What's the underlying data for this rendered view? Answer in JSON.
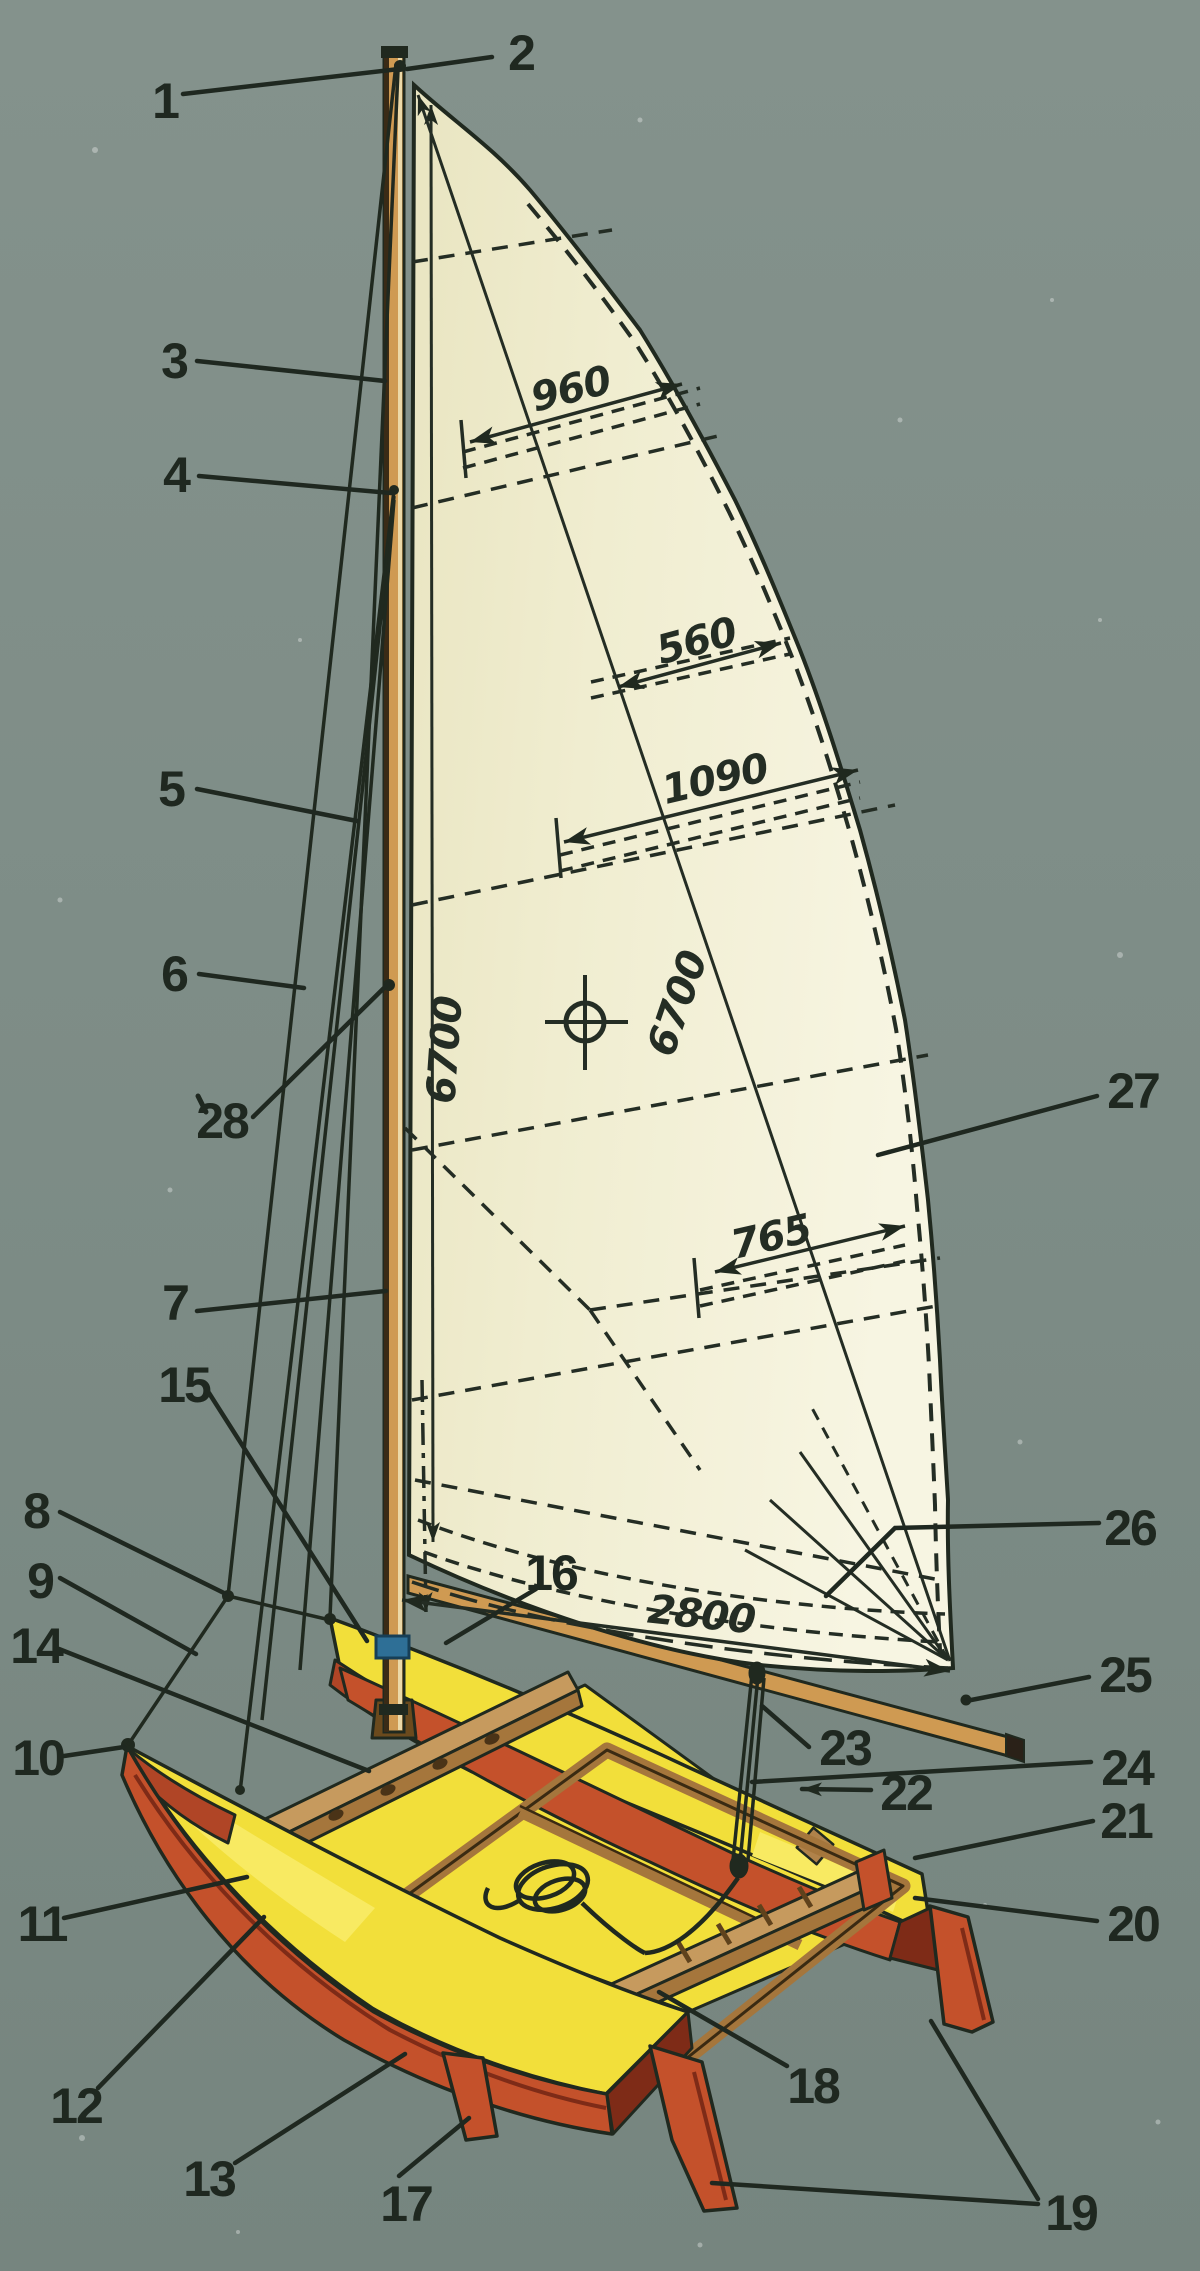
{
  "figure": {
    "kind": "technical-parts-diagram",
    "subject": "sailing catamaran with fully battened mainsail",
    "style": "vintage magazine color plate",
    "background_color": "#7d8c86",
    "colors": {
      "sail": "#f0edd0",
      "deck_yellow": "#f2df3a",
      "hull_red": "#c4512b",
      "spar_tan": "#cf9a52",
      "beam_brown": "#a5763c",
      "ink": "#20291f",
      "step_blue": "#2e6f96"
    }
  },
  "callouts": {
    "c1": "1",
    "c2": "2",
    "c3": "3",
    "c4": "4",
    "c5": "5",
    "c6": "6",
    "c7": "7",
    "c8": "8",
    "c9": "9",
    "c10": "10",
    "c11": "11",
    "c12": "12",
    "c13": "13",
    "c14": "14",
    "c15": "15",
    "c16": "16",
    "c17": "17",
    "c18": "18",
    "c19": "19",
    "c20": "20",
    "c21": "21",
    "c22": "22",
    "c23": "23",
    "c24": "24",
    "c25": "25",
    "c26": "26",
    "c27": "27",
    "c28": "28"
  },
  "dimensions": {
    "batten_top": "960",
    "batten_upper": "560",
    "batten_middle": "1090",
    "luff": "6700",
    "leech": "6700",
    "batten_lower": "765",
    "foot": "2800"
  }
}
